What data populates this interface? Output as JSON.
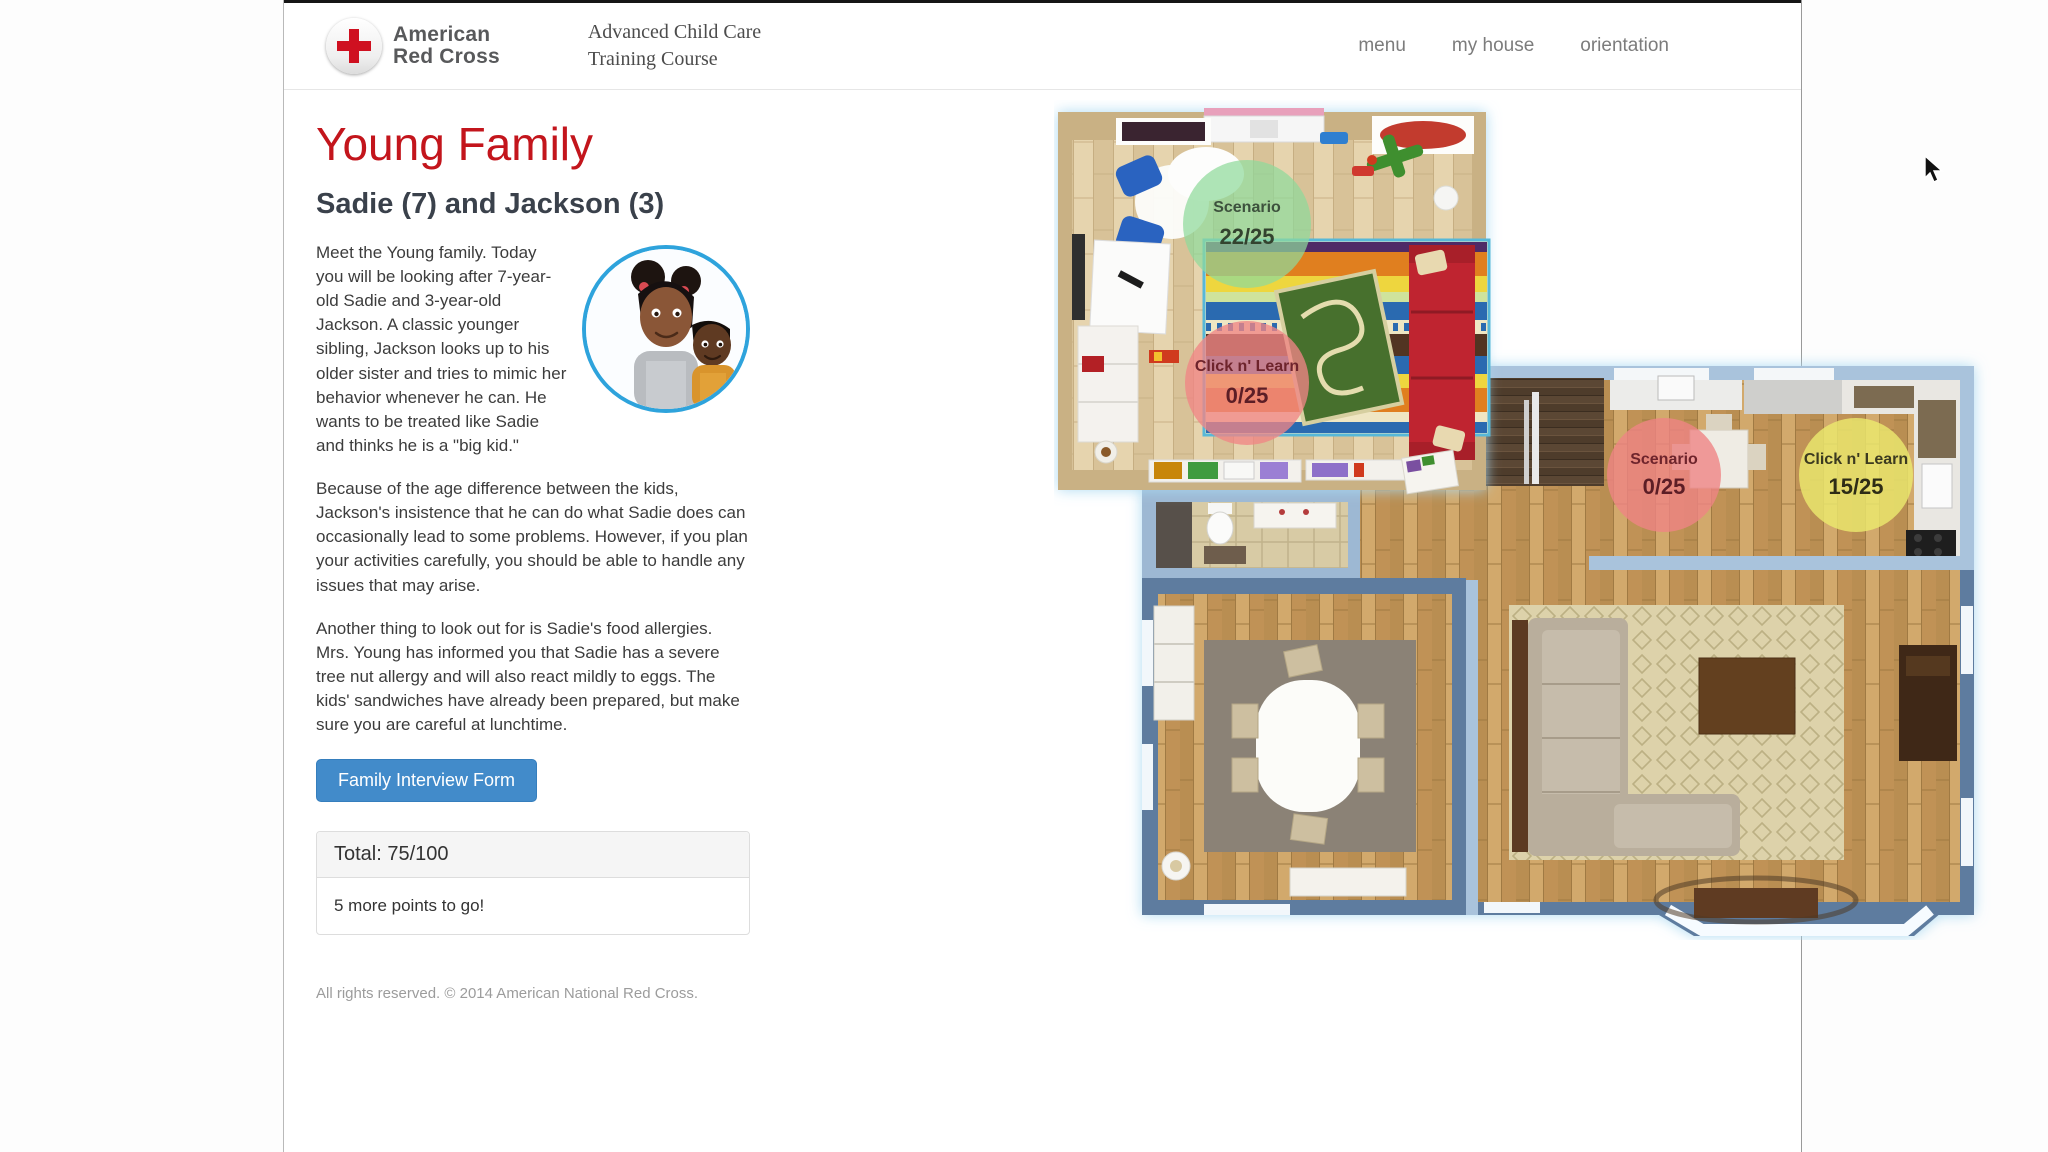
{
  "header": {
    "brand_line1": "American",
    "brand_line2": "Red Cross",
    "course_line1": "Advanced Child Care",
    "course_line2": "Training Course",
    "nav": [
      {
        "label": "menu"
      },
      {
        "label": "my house"
      },
      {
        "label": "orientation"
      }
    ]
  },
  "sidebar": {
    "title": "Young Family",
    "subtitle": "Sadie (7) and Jackson (3)",
    "paragraph1": "Meet the Young family. Today you will be looking after 7-year-old Sadie and 3-year-old Jackson. A classic younger sibling, Jackson looks up to his older sister and tries to mimic her behavior whenever he can. He wants to be treated like Sadie and thinks he is a \"big kid.\"",
    "paragraph2": "Because of the age difference between the kids, Jackson's insistence that he can do what Sadie does can occasionally lead to some problems. However, if you plan your activities carefully, you should be able to handle any issues that may arise.",
    "paragraph3": "Another thing to look out for is Sadie's food allergies. Mrs. Young has informed you that Sadie has a severe tree nut allergy and will also react mildly to eggs. The kids' sandwiches have already been prepared, but make sure you are careful at lunchtime.",
    "interview_button_label": "Family Interview Form",
    "score_panel": {
      "total_label": "Total: 75/100",
      "remaining_text": "5 more points to go!"
    },
    "copyright": "All rights reserved. © 2014 American National Red Cross."
  },
  "floorplan": {
    "hotspots": [
      {
        "room": "bedroom",
        "type": "Scenario",
        "score": "22/25",
        "fill": "#8fd99b",
        "text_color": "#3d513d"
      },
      {
        "room": "bedroom",
        "type": "Click n' Learn",
        "score": "0/25",
        "fill": "#ef8585",
        "text_color": "#6e242c"
      },
      {
        "room": "kitchen",
        "type": "Scenario",
        "score": "0/25",
        "fill": "#ef8585",
        "text_color": "#6e242c"
      },
      {
        "room": "kitchen",
        "type": "Click n' Learn",
        "score": "15/25",
        "fill": "#ece96e",
        "text_color": "#3c3a20"
      }
    ]
  },
  "colors": {
    "accent_red": "#c3151c",
    "button_blue": "#428bca",
    "hotspot_green": "#8fd99b",
    "hotspot_red": "#ef8585",
    "hotspot_yellow": "#ece96e"
  }
}
